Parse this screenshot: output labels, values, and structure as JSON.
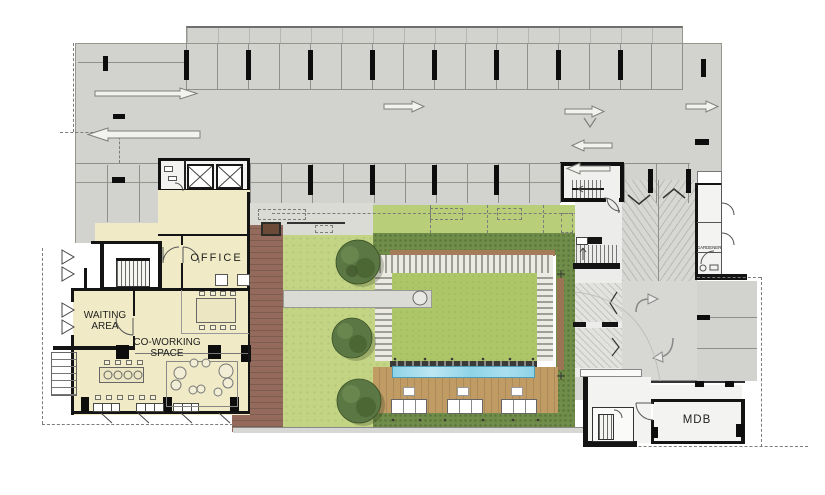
{
  "labels": {
    "office": "OFFICE",
    "waiting_area": [
      "WAITING",
      "AREA"
    ],
    "coworking_space": [
      "CO-WORKING",
      "SPACE"
    ],
    "gardener": "GARDENER",
    "mdb": "MDB"
  },
  "colors": {
    "parking_gray": "#d2d2cf",
    "parking_gray2": "#d7d7d3",
    "stall_line": "#8f8f8b",
    "wall_black": "#141414",
    "cream_room": "#f0ebc6",
    "lawn_left": "#c3d485",
    "lawn_center": "#adc768",
    "lawn_top": "#b9ce79",
    "hedge": "#708d4a",
    "hedge_dot": "#5c773a",
    "tree": "#5b7743",
    "pool": "#8fd3e8",
    "deck_tan": "#c09b64",
    "deck_brown": "#936a5c",
    "walk": "#dbdbd6",
    "steps_light": "#ebeae3",
    "steps_dark": "#a09f97",
    "white_room": "#f3f3f1"
  }
}
